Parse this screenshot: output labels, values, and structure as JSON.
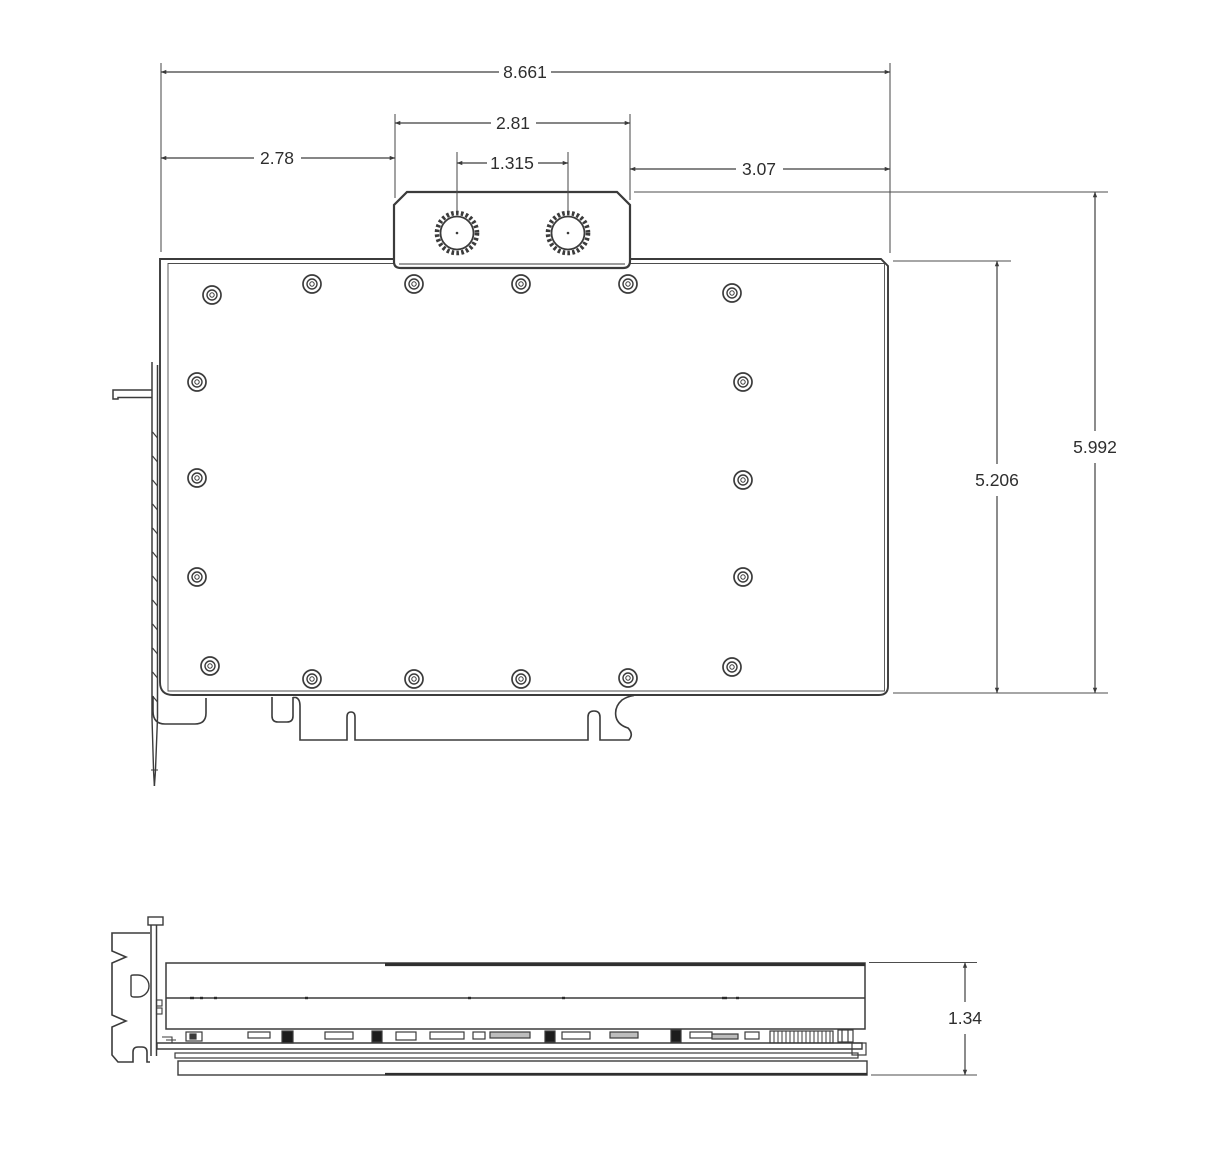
{
  "meta": {
    "drawing_type": "dimensioned technical drawing",
    "subject": "graphics-card water block, top and side views",
    "units_implied": "inches",
    "background": "#ffffff",
    "line_color": "#3b3b3b",
    "text_color": "#2e2e2e"
  },
  "dims": {
    "overall_width": "8.661",
    "terminal_width": "2.81",
    "terminal_left_offset": "2.78",
    "port_spacing": "1.315",
    "terminal_right_offset": "3.07",
    "overall_height": "5.992",
    "body_height": "5.206",
    "side_thickness": "1.34"
  }
}
